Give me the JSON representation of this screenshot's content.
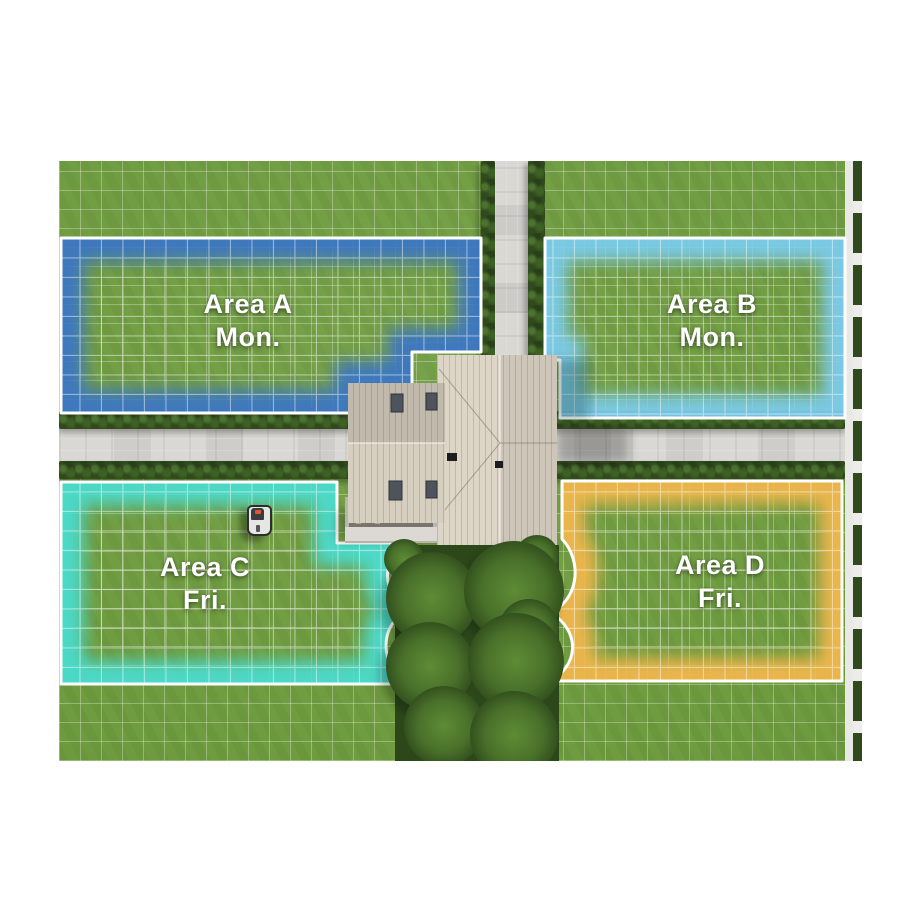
{
  "zones": [
    {
      "id": "zone-a",
      "name": "Area A",
      "day": "Mon.",
      "glow_color": "#3a76c8"
    },
    {
      "id": "zone-b",
      "name": "Area B",
      "day": "Mon.",
      "glow_color": "#7bcdf1"
    },
    {
      "id": "zone-c",
      "name": "Area C",
      "day": "Fri.",
      "glow_color": "#49ded2"
    },
    {
      "id": "zone-d",
      "name": "Area D",
      "day": "Fri.",
      "glow_color": "#f4b84d"
    }
  ],
  "colors": {
    "page_bg": "#ffffff",
    "grass": "#6f9c3f",
    "grid_line": "rgba(255,255,255,0.30)",
    "road": "#d9d8d4",
    "hedge": "#30491d",
    "zone_border": "#ffffff",
    "roof_light": "#ddd6c7",
    "roof_mid": "#d6cfc0",
    "tree_dark": "#2c481a"
  },
  "objects": {
    "mower_icon": "robot-mower"
  }
}
